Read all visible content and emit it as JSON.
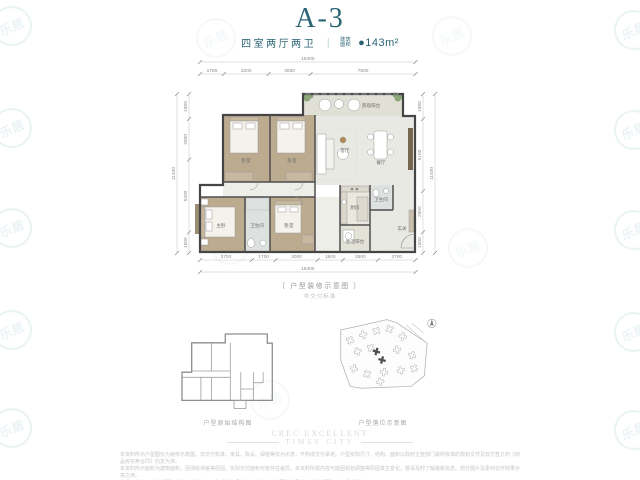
{
  "colors": {
    "accent_teal": "#2a6474",
    "watermark_teal": "#3a8fa0"
  },
  "watermark": {
    "text": "乐居"
  },
  "page": {
    "title": "A-3",
    "subtitle_type": "四室两厅两卫",
    "divider": "｜",
    "area_label_line1": "建筑",
    "area_label_line2": "面积",
    "area_value": "●143m²"
  },
  "plan": {
    "dims": {
      "top": {
        "total": "15400",
        "segs": [
          "1700",
          "3200",
          "3000",
          "7500"
        ]
      },
      "bottom": {
        "total": "15400",
        "segs": [
          "3700",
          "1700",
          "3000",
          "1800",
          "2500",
          "2700"
        ]
      },
      "left": {
        "total": "11400",
        "segs": [
          "1800",
          "2900",
          "5200",
          "1500"
        ]
      },
      "right": {
        "total": "11400",
        "segs": [
          "1800",
          "5150",
          "2950",
          "1500"
        ]
      }
    },
    "rooms": {
      "balcony_view": "景观阳台",
      "living": "客厅",
      "dining": "餐厅",
      "kitchen": "厨房",
      "entry": "玄关",
      "service_balcony": "生活阳台",
      "master": "主卧",
      "bedroom_a": "卧室",
      "bedroom_b": "卧室",
      "bedroom_c": "卧室",
      "bath_a": "卫生间",
      "bath_b": "卫生间"
    },
    "caption": "〔 户型装修示意图 〕",
    "caption_note": "非交付标准"
  },
  "structure": {
    "caption": "户型原始结构图"
  },
  "site": {
    "caption": "户型落位示意图"
  },
  "footer": {
    "logo_line1": "CREC EXCELLENT",
    "logo_line2": "TIMES CITY",
    "disclaimer1": "本资料所示户型图仅为装修示意图，非交付标准，家具、陈设、绿植等仅为示意，不构成交付承诺。户型实际尺寸、结构、面积以政府主管部门最终核准的规划文件及双方签订的《商品房买卖合同》约定为准。",
    "disclaimer2": "本资料所示面积为建筑面积，因测绘误差等原因，实际交付面积可能存在差异。本资料所载内容可能因规划调整等原因发生变化，敬请及时了解最新信息。部分图片及素材仅作效果示意之用。",
    "disclaimer3": "交通、教育、商业等配套信息仅供参考，不构成任何承诺。本资料不作为要约或承诺，最终解释权归开发商所有。"
  }
}
